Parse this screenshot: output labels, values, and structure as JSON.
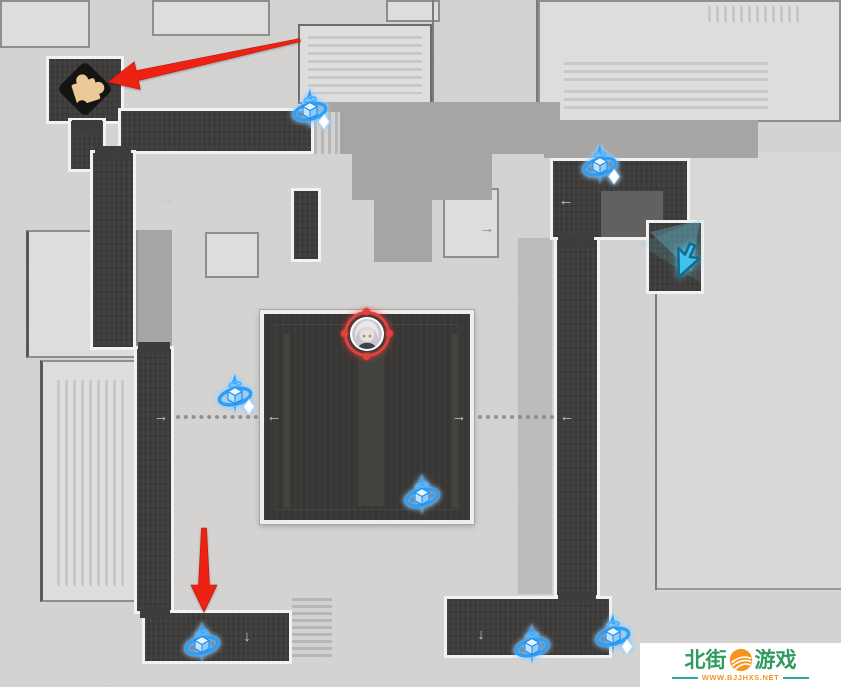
{
  "watermark": {
    "site_left": "北街",
    "site_right": "游戏",
    "url": "WWW.BJJHXS.NET",
    "green": "#2f9b5e",
    "orange": "#f7941d",
    "teal": "#2fa8a0"
  },
  "markers": {
    "puzzle": {
      "x": 85,
      "y": 89
    },
    "player": {
      "x": 367,
      "y": 334
    },
    "cursor": {
      "x": 682,
      "y": 258
    },
    "enemies": [
      {
        "x": 310,
        "y": 112,
        "sparkle": true
      },
      {
        "x": 600,
        "y": 167,
        "sparkle": true
      },
      {
        "x": 235,
        "y": 397,
        "sparkle": true
      },
      {
        "x": 422,
        "y": 498,
        "sparkle": false
      },
      {
        "x": 202,
        "y": 646,
        "sparkle": false
      },
      {
        "x": 532,
        "y": 648,
        "sparkle": false
      },
      {
        "x": 613,
        "y": 637,
        "sparkle": true
      }
    ]
  },
  "nav_arrows": [
    {
      "glyph": "→",
      "x": 167,
      "y": 200,
      "tone": "light"
    },
    {
      "glyph": "→",
      "x": 487,
      "y": 229,
      "tone": "dark"
    },
    {
      "glyph": "←",
      "x": 566,
      "y": 201,
      "tone": "light"
    },
    {
      "glyph": "→",
      "x": 161,
      "y": 417,
      "tone": "light"
    },
    {
      "glyph": "←",
      "x": 274,
      "y": 417,
      "tone": "light"
    },
    {
      "glyph": "→",
      "x": 459,
      "y": 417,
      "tone": "light"
    },
    {
      "glyph": "←",
      "x": 567,
      "y": 417,
      "tone": "light"
    },
    {
      "glyph": "↓",
      "x": 247,
      "y": 637,
      "tone": "light"
    },
    {
      "glyph": "↓",
      "x": 481,
      "y": 635,
      "tone": "light"
    }
  ],
  "dotted_paths": [
    {
      "x": 176,
      "y": 417,
      "w": 82
    },
    {
      "x": 478,
      "y": 417,
      "w": 76
    }
  ],
  "red_arrows": [
    {
      "name": "red-arrow-to-puzzle",
      "points": "299.7,38.5 136.2,70.7 134.3,61.9 108,82 140.3,89.3 138.4,80.5 300.3,41.5"
    },
    {
      "name": "red-arrow-to-bottom-room",
      "points": "201.5,528 198.5,585 191,585 204,612 217,585 209.5,585 206.5,528"
    }
  ],
  "beams": [
    {
      "points": "638,244 704,218 700,282",
      "fill": "rgba(110,210,235,0.14)"
    },
    {
      "points": "650,232 700,220 692,272",
      "fill": "rgba(110,210,235,0.30)"
    }
  ],
  "colors": {
    "background": "#d3d2d0",
    "building": "#dedddb",
    "plaza": "#a6a5a3",
    "corridor_dark": "#3e3d3b",
    "border_white": "#f3f2f0",
    "enemy_blue": "#2f9ff5",
    "annotation_red": "#ed2212",
    "cursor_cyan": "#3cc4ee",
    "puzzle_tan": "#ecca97",
    "player_ring_red": "#e2413d"
  }
}
